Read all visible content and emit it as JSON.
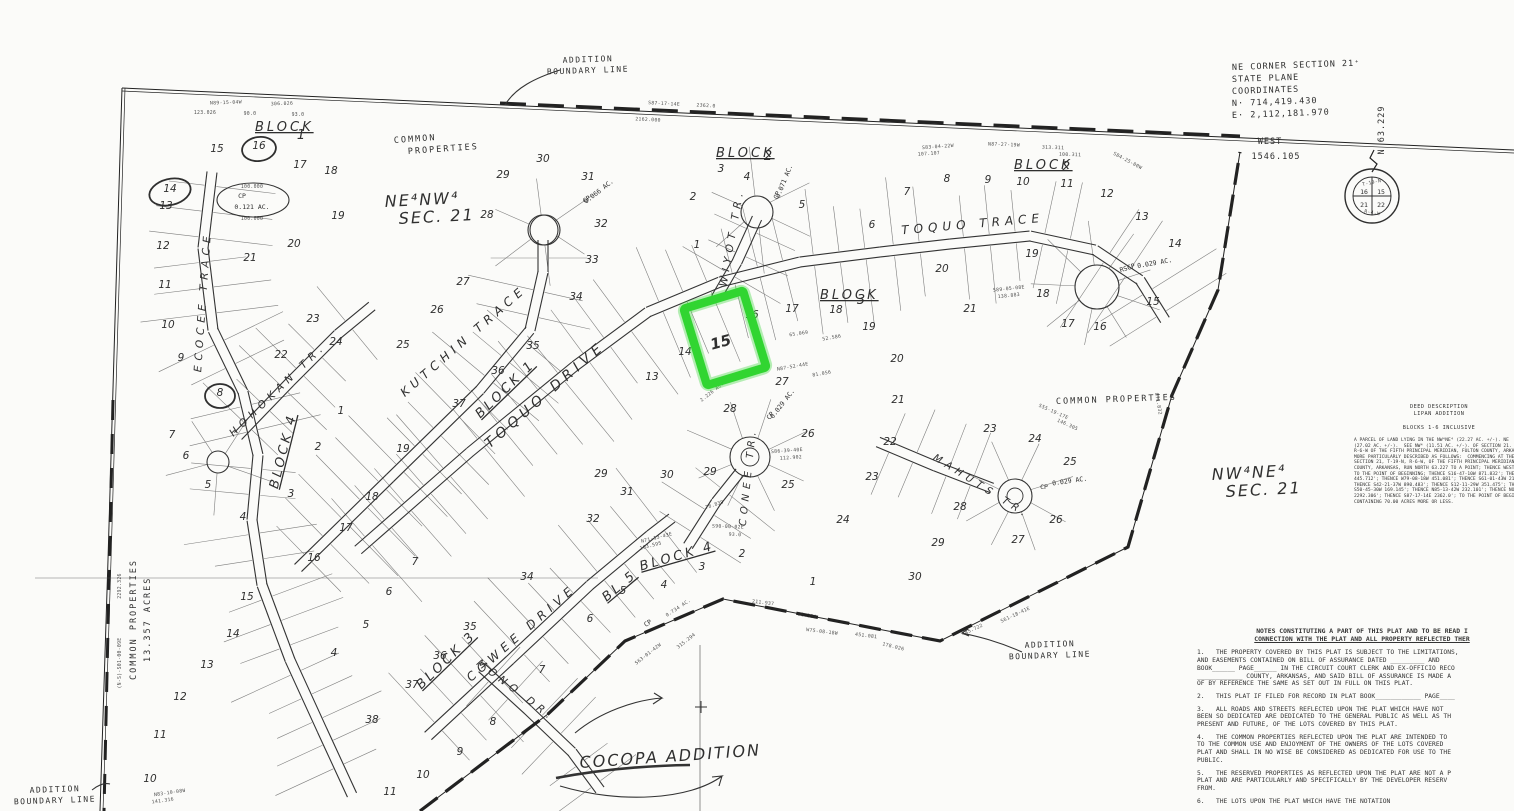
{
  "colors": {
    "ink": "#2f2f2f",
    "thin": "#4a4a4a",
    "highlight": "#31d531",
    "paper": "#fbfbf9"
  },
  "top": {
    "ne_corner_lines": [
      "NE CORNER SECTION 21⁺",
      "STATE PLANE",
      "COORDINATES",
      "N· 714,419.430",
      "E· 2,112,181.970"
    ],
    "west_label": "WEST",
    "west_value": "1546.105",
    "north_tick": "N 63.229"
  },
  "section_marker": {
    "top": "T-19-N",
    "bottom": "R-4-W",
    "quads": [
      "16",
      "15",
      "21",
      "22"
    ]
  },
  "boundary_labels": [
    {
      "l1": "ADDITION",
      "l2": "BOUNDARY  LINE",
      "x": 588,
      "y": 62
    },
    {
      "l1": "ADDITION",
      "l2": "BOUNDARY  LINE",
      "x": 1050,
      "y": 647
    },
    {
      "l1": "ADDITION",
      "l2": "BOUNDARY  LINE",
      "x": 55,
      "y": 792
    }
  ],
  "streets": [
    {
      "t": "TOQUO  DRIVE",
      "x": 548,
      "y": 398,
      "r": -41,
      "s": 14
    },
    {
      "t": "KUTCHIN  TRACE",
      "x": 466,
      "y": 344,
      "r": -41,
      "s": 12
    },
    {
      "t": "TOQUO  TRACE",
      "x": 973,
      "y": 228,
      "r": -5,
      "s": 12
    },
    {
      "t": "WIYOT  TR.",
      "x": 735,
      "y": 238,
      "r": -80,
      "s": 10.5
    },
    {
      "t": "CONEE  TR.",
      "x": 751,
      "y": 477,
      "r": -84,
      "s": 10
    },
    {
      "t": "MAHUTS  TR.",
      "x": 980,
      "y": 489,
      "r": 32,
      "s": 10
    },
    {
      "t": "HOHOKAN  TR.",
      "x": 280,
      "y": 392,
      "r": -44,
      "s": 10.5
    },
    {
      "t": "ECOCEE  TRACE",
      "x": 206,
      "y": 302,
      "r": -86,
      "s": 10.5
    },
    {
      "t": "COWEE  DRIVE",
      "x": 524,
      "y": 636,
      "r": -41,
      "s": 12
    },
    {
      "t": "MONO  DR.",
      "x": 514,
      "y": 693,
      "r": 37,
      "s": 10.5
    }
  ],
  "blocks": [
    {
      "w": "BLOCK",
      "n": "1",
      "x": 255,
      "y": 131,
      "nx": 301,
      "ny": 139,
      "r": 0
    },
    {
      "w": "BLOCK",
      "n": "2",
      "x": 716,
      "y": 157,
      "nx": 768,
      "ny": 160,
      "r": 0
    },
    {
      "w": "BLOCK",
      "n": "2",
      "x": 1014,
      "y": 169,
      "nx": 1066,
      "ny": 171,
      "r": 0
    },
    {
      "w": "BLOCK",
      "n": "3",
      "x": 820,
      "y": 299,
      "nx": 861,
      "ny": 304,
      "r": 0
    },
    {
      "w": "BLOCK  1",
      "n": "",
      "x": 508,
      "y": 392,
      "r": -44,
      "inline": true
    },
    {
      "w": "BLOCK  4",
      "n": "",
      "x": 287,
      "y": 452,
      "r": -76,
      "inline": true
    },
    {
      "w": "BLOCK  3",
      "n": "",
      "x": 449,
      "y": 663,
      "r": -44,
      "inline": true
    },
    {
      "w": "BLOCK  4",
      "n": "",
      "x": 678,
      "y": 560,
      "r": -16,
      "inline": true
    },
    {
      "w": "BL  5",
      "n": "",
      "x": 622,
      "y": 589,
      "r": -40,
      "inline": true
    }
  ],
  "areas": [
    {
      "lines": [
        "COMMON",
        "  PROPERTIES"
      ],
      "x": 394,
      "y": 143,
      "r": -4,
      "cls": "arealbl"
    },
    {
      "lines": [
        "COMMON  PROPERTIES"
      ],
      "x": 1056,
      "y": 404,
      "r": -2,
      "cls": "arealbl"
    },
    {
      "lines": [
        "COMMON  PROPERTIES"
      ],
      "x": 136,
      "y": 680,
      "r": -90,
      "cls": "arealbl"
    },
    {
      "lines": [
        "13.357  ACRES"
      ],
      "x": 150,
      "y": 662,
      "r": -90,
      "cls": "arealbl"
    },
    {
      "lines": [
        "NE⁴NW⁴",
        "SEC.  21"
      ],
      "x": 385,
      "y": 207,
      "r": -3,
      "cls": "handbig"
    },
    {
      "lines": [
        "NW⁴NE⁴",
        "SEC.  21"
      ],
      "x": 1212,
      "y": 480,
      "r": -3,
      "cls": "handbig"
    }
  ],
  "cocopa": {
    "label": "COCOPA ADDITION",
    "x": 580,
    "y": 768
  },
  "lots": [
    [
      15,
      217,
      152
    ],
    [
      16,
      259,
      149
    ],
    [
      17,
      300,
      168
    ],
    [
      18,
      331,
      174
    ],
    [
      14,
      170,
      192
    ],
    [
      13,
      166,
      209
    ],
    [
      19,
      338,
      219
    ],
    [
      12,
      163,
      249
    ],
    [
      20,
      294,
      247
    ],
    [
      21,
      250,
      261
    ],
    [
      11,
      165,
      288
    ],
    [
      10,
      168,
      328
    ],
    [
      9,
      181,
      361
    ],
    [
      22,
      281,
      358
    ],
    [
      23,
      313,
      322
    ],
    [
      24,
      336,
      345
    ],
    [
      8,
      220,
      396
    ],
    [
      1,
      341,
      414
    ],
    [
      2,
      318,
      450
    ],
    [
      3,
      291,
      497
    ],
    [
      4,
      243,
      520
    ],
    [
      5,
      208,
      488
    ],
    [
      6,
      186,
      459
    ],
    [
      7,
      172,
      438
    ],
    [
      15,
      247,
      600
    ],
    [
      14,
      233,
      637
    ],
    [
      13,
      207,
      668
    ],
    [
      12,
      180,
      700
    ],
    [
      11,
      160,
      738
    ],
    [
      10,
      150,
      782
    ],
    [
      25,
      403,
      348
    ],
    [
      26,
      437,
      313
    ],
    [
      27,
      463,
      285
    ],
    [
      34,
      576,
      300
    ],
    [
      35,
      533,
      349
    ],
    [
      36,
      498,
      374
    ],
    [
      37,
      459,
      407
    ],
    [
      19,
      403,
      452
    ],
    [
      18,
      372,
      500
    ],
    [
      17,
      346,
      531
    ],
    [
      16,
      314,
      561
    ],
    [
      29,
      503,
      178
    ],
    [
      30,
      543,
      162
    ],
    [
      31,
      588,
      180
    ],
    [
      28,
      487,
      218
    ],
    [
      32,
      601,
      227
    ],
    [
      33,
      592,
      263
    ],
    [
      2,
      693,
      200
    ],
    [
      3,
      721,
      172
    ],
    [
      4,
      747,
      180
    ],
    [
      5,
      802,
      208
    ],
    [
      1,
      697,
      248
    ],
    [
      6,
      872,
      228
    ],
    [
      7,
      907,
      195
    ],
    [
      8,
      947,
      182
    ],
    [
      9,
      988,
      183
    ],
    [
      10,
      1023,
      185
    ],
    [
      11,
      1067,
      187
    ],
    [
      12,
      1107,
      197
    ],
    [
      13,
      1142,
      220
    ],
    [
      14,
      1175,
      247
    ],
    [
      15,
      1153,
      305
    ],
    [
      16,
      1100,
      330
    ],
    [
      17,
      1068,
      327
    ],
    [
      18,
      1043,
      297
    ],
    [
      19,
      1032,
      257
    ],
    [
      20,
      942,
      272
    ],
    [
      21,
      970,
      312
    ],
    [
      13,
      652,
      380
    ],
    [
      14,
      685,
      355
    ],
    [
      16,
      752,
      318
    ],
    [
      17,
      792,
      312
    ],
    [
      18,
      836,
      313
    ],
    [
      19,
      869,
      330
    ],
    [
      20,
      897,
      362
    ],
    [
      21,
      898,
      403
    ],
    [
      22,
      890,
      445
    ],
    [
      23,
      872,
      480
    ],
    [
      24,
      843,
      523
    ],
    [
      25,
      788,
      488
    ],
    [
      26,
      808,
      437
    ],
    [
      27,
      782,
      385
    ],
    [
      28,
      730,
      412
    ],
    [
      29,
      710,
      475
    ],
    [
      30,
      667,
      478
    ],
    [
      29,
      601,
      477
    ],
    [
      31,
      627,
      495
    ],
    [
      32,
      593,
      522
    ],
    [
      2,
      742,
      557
    ],
    [
      1,
      813,
      585
    ],
    [
      3,
      702,
      570
    ],
    [
      4,
      664,
      588
    ],
    [
      5,
      623,
      594
    ],
    [
      6,
      590,
      622
    ],
    [
      7,
      542,
      673
    ],
    [
      8,
      493,
      725
    ],
    [
      9,
      460,
      755
    ],
    [
      10,
      423,
      778
    ],
    [
      11,
      390,
      795
    ],
    [
      34,
      527,
      580
    ],
    [
      35,
      470,
      630
    ],
    [
      36,
      440,
      659
    ],
    [
      37,
      412,
      688
    ],
    [
      38,
      372,
      723
    ],
    [
      5,
      366,
      628
    ],
    [
      6,
      389,
      595
    ],
    [
      7,
      415,
      565
    ],
    [
      4,
      334,
      656
    ],
    [
      23,
      990,
      432
    ],
    [
      24,
      1035,
      442
    ],
    [
      25,
      1070,
      465
    ],
    [
      26,
      1056,
      523
    ],
    [
      27,
      1018,
      543
    ],
    [
      28,
      960,
      510
    ],
    [
      29,
      938,
      546
    ],
    [
      30,
      915,
      580
    ]
  ],
  "highlight_lot": {
    "n": "15",
    "x": 722,
    "y": 347
  },
  "bearings": [
    [
      "N89-15-04W",
      226,
      104,
      -2
    ],
    [
      "306.026",
      282,
      105,
      -2
    ],
    [
      "123.026",
      205,
      114,
      0
    ],
    [
      "90.0",
      250,
      115,
      0
    ],
    [
      "93.0",
      298,
      116,
      0
    ],
    [
      "100.000",
      252,
      188,
      0
    ],
    [
      "100.000",
      252,
      220,
      0
    ],
    [
      "S87-17-14E",
      664,
      105,
      3
    ],
    [
      "2362.0",
      706,
      107,
      3
    ],
    [
      "2162.000",
      648,
      121,
      3
    ],
    [
      "S83-04-22W",
      938,
      148,
      -4
    ],
    [
      "107.107",
      929,
      155,
      -4
    ],
    [
      "N87-27-19W",
      1004,
      146,
      2
    ],
    [
      "313.311",
      1053,
      149,
      2
    ],
    [
      "100.311",
      1070,
      156,
      2
    ],
    [
      "S84-25-00W",
      1127,
      162,
      28
    ],
    [
      "871.832",
      1157,
      404,
      80
    ],
    [
      "S61-18-41E",
      1016,
      616,
      -25
    ],
    [
      "445.722",
      973,
      631,
      -25
    ],
    [
      "W75-08-18W",
      822,
      633,
      7
    ],
    [
      "451.081",
      866,
      637,
      7
    ],
    [
      "178.026",
      893,
      648,
      14
    ],
    [
      "211.937",
      763,
      604,
      7
    ],
    [
      "98.350",
      807,
      617,
      9
    ],
    [
      "S63-01-42W",
      649,
      655,
      -38
    ],
    [
      "315.294",
      687,
      642,
      -38
    ],
    [
      "2292.326",
      121,
      586,
      -90
    ],
    [
      "(N-S)-S01-00-09E",
      121,
      663,
      -90
    ],
    [
      "N83-10-08W",
      170,
      794,
      -8
    ],
    [
      "141.316",
      163,
      802,
      -8
    ],
    [
      "S86-39-40E",
      787,
      452,
      -4
    ],
    [
      "112.902",
      791,
      459,
      -4
    ],
    [
      "N87-52-44E",
      793,
      368,
      -10
    ],
    [
      "81.056",
      822,
      375,
      -10
    ],
    [
      "2.226 AC.",
      713,
      393,
      -38
    ],
    [
      "0.734 AC.",
      679,
      609,
      -33
    ],
    [
      "S90-00-02E",
      728,
      528,
      2
    ],
    [
      "93.0",
      735,
      536,
      2
    ],
    [
      "N71-13-43E",
      657,
      539,
      -14
    ],
    [
      "103.595",
      651,
      547,
      -14
    ],
    [
      "78.839",
      715,
      506,
      -18
    ],
    [
      "S55-19-17E",
      1053,
      413,
      24
    ],
    [
      "146.305",
      1067,
      426,
      24
    ],
    [
      "S89-05-08E",
      1009,
      290,
      -6
    ],
    [
      "138.883",
      1009,
      297,
      -6
    ],
    [
      "65.069",
      799,
      335,
      -8
    ],
    [
      "52.586",
      832,
      339,
      -10
    ]
  ],
  "cp_labels": [
    [
      "CP",
      242,
      198,
      0
    ],
    [
      "0.121 AC.",
      252,
      209,
      0
    ],
    [
      "CP",
      779,
      196,
      -68
    ],
    [
      "0.071 AC.",
      786,
      182,
      -68
    ],
    [
      "CP",
      588,
      201,
      -38
    ],
    [
      "0.066 AC.",
      600,
      193,
      -38
    ],
    [
      "RSCP",
      1128,
      270,
      -18
    ],
    [
      "0.029 AC.",
      1155,
      265,
      -10
    ],
    [
      "CP",
      1044,
      489,
      0
    ],
    [
      "0.029 AC.",
      1070,
      483,
      -8
    ],
    [
      "CP",
      772,
      417,
      -52
    ],
    [
      "0.029 AC.",
      784,
      405,
      -52
    ],
    [
      "CP",
      649,
      625,
      -33
    ]
  ],
  "deed": {
    "title_lines": [
      "DEED DESCRIPTION",
      "LIPAN ADDITION",
      "",
      "BLOCKS 1-6 INCLUSIVE"
    ],
    "body_lines": [
      "A PARCEL OF LAND LYING IN THE NW⁴NE⁴ (22.27 AC. +/-). NE",
      "(27.02 AC. +/-).  SEE NW⁴ (11.51 AC. +/-). OF SECTION 21.",
      "R-6-W OF THE FIFTH PRINCIPAL MERIDIAN, FULTON COUNTY, ARKAN",
      "MORE PARTICULARLY DESCRIBED AS FOLLOWS:  COMMENCING AT THE",
      "SECTION 21, T-19-N, R-6-W, OF THE FIFTH PRINCIPAL MERIDIAN,",
      "COUNTY, ARKANSAS, RUN NORTH 63.227 TO A POINT; THENCE WEST",
      "TO THE POINT OF BEGINNING; THENCE S16-47-10W 871.832'; THEN",
      "445.712'; THENCE W79-08-18W 451.081'; THENCE S61-01-43W 217",
      "THENCE S42-21-37W 890.483'; THENCE S12-11-29W 351.475'; THE",
      "S50-45-30W 169.145'; THENCE N85-13-42W 232.101'; THENCE NOR",
      "2292.306'; THENCE S87-17-14E 2362.0'; TO THE POINT OF BEGIN",
      "CONTAINING 70.00 ACRES MORE OR LESS."
    ]
  },
  "notes": {
    "heading_lines": [
      "NOTES CONSTITUTING A PART OF THIS PLAT AND TO BE READ I",
      "CONNECTION WITH THE PLAT AND ALL PROPERTY REFLECTED THER"
    ],
    "paragraphs": [
      [
        "1.   THE PROPERTY COVERED BY THIS PLAT IS SUBJECT TO THE LIMITATIONS,",
        "AND EASEMENTS CONTAINED ON BILL OF ASSURANCE DATED _________ AND",
        "BOOK______ PAGE______ IN THE CIRCUIT COURT CLERK AND EX-OFFICIO RECO",
        "____________ COUNTY, ARKANSAS, AND SAID BILL OF ASSURANCE IS MADE A",
        "OF BY REFERENCE THE SAME AS SET OUT IN FULL ON THIS PLAT."
      ],
      [
        "2.   THIS PLAT IF FILED FOR RECORD IN PLAT BOOK____________ PAGE____"
      ],
      [
        "3.   ALL ROADS AND STREETS REFLECTED UPON THE PLAT WHICH HAVE NOT",
        "BEEN SO DEDICATED ARE DEDICATED TO THE GENERAL PUBLIC AS WELL AS TH",
        "PRESENT AND FUTURE, OF THE LOTS COVERED BY THIS PLAT."
      ],
      [
        "4.   THE COMMON PROPERTIES REFLECTED UPON THE PLAT ARE INTENDED TO",
        "TO THE COMMON USE AND ENJOYMENT OF THE OWNERS OF THE LOTS COVERED",
        "PLAT AND SHALL IN NO WISE BE CONSIDERED AS DEDICATED FOR USE TO THE",
        "PUBLIC."
      ],
      [
        "5.   THE RESERVED PROPERTIES AS REFLECTED UPON THE PLAT ARE NOT A P",
        "PLAT AND ARE PARTICULARLY AND SPECIFICALLY BY THE DEVELOPER RESERV",
        "FROM."
      ],
      [
        "6.   THE LOTS UPON THE PLAT WHICH HAVE THE NOTATION"
      ]
    ]
  }
}
